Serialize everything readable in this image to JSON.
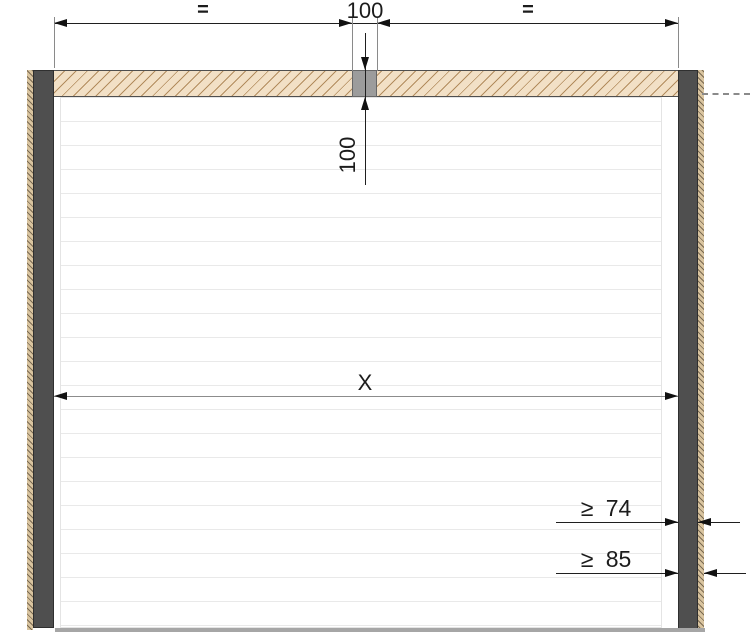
{
  "diagram": {
    "labels": {
      "equal_left": "=",
      "width_center": "100",
      "equal_right": "=",
      "lintel_depth": "100",
      "opening_width": "X",
      "frame_min_74": "≥ 74",
      "frame_min_85": "≥ 85"
    },
    "colors": {
      "lintel_fill": "#f2e0c6",
      "lintel_hatch": "#b28c5e",
      "frame_post": "#4f4f4f",
      "wall_edge_hatch": "#d9c49f",
      "center_block": "#9c9c9c",
      "panel_line": "#e9e9e9",
      "dimension_line": "#1f1f1f",
      "auxiliary_line": "#8c8c8c",
      "floor_line": "#a6a6a6"
    }
  }
}
